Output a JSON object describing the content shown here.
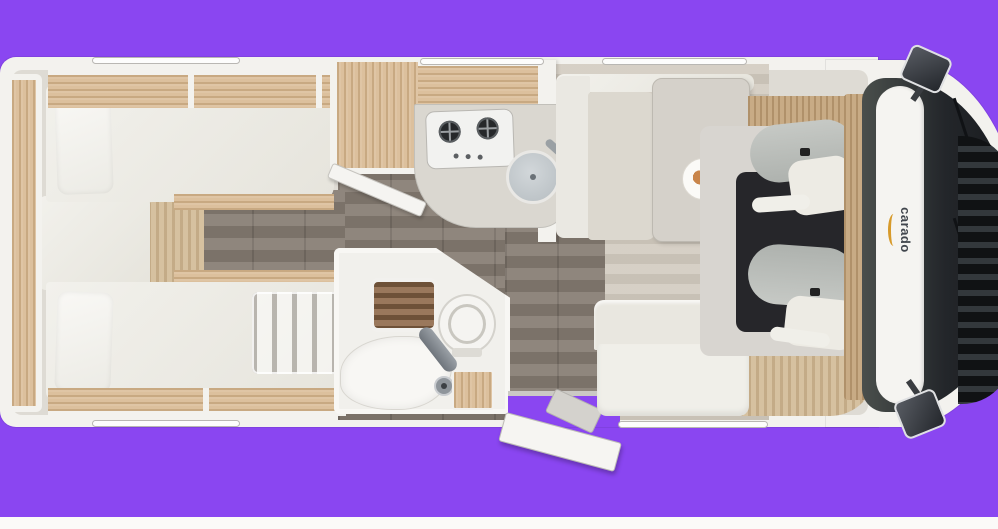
{
  "page": {
    "background_color": "#8a46f1",
    "bottom_strip_color": "#fbfaf8"
  },
  "vehicle": {
    "brand": {
      "logo_text": "carado",
      "logo_accent_color": "#d79a2b"
    },
    "palette": {
      "body_wall": "#f3f2ee",
      "furniture_wood": "#dcc09d",
      "floor_dark_wood": "#877d73",
      "floor_light": "#d1cabe",
      "upholstery": "#edece6",
      "worktop": "#dad7d0",
      "cab_mat": "#26262a"
    },
    "rooms": {
      "rear_bedroom": {
        "name": "twin-single-beds",
        "features": [
          "bed-top",
          "bed-bottom",
          "pillow-top",
          "pillow-bottom",
          "bunk-ladder",
          "overhead-lockers",
          "rear-shelf"
        ]
      },
      "kitchen": {
        "name": "kitchenette",
        "features": [
          "two-burner-hob",
          "round-sink",
          "worktop",
          "overhead-locker",
          "wardrobe"
        ]
      },
      "washroom": {
        "name": "washroom",
        "features": [
          "shower-grate",
          "toilet",
          "washbasin",
          "mixer-tap",
          "vanity-cabinet",
          "washroom-door-open"
        ]
      },
      "dinette": {
        "name": "half-dinette",
        "features": [
          "side-bench",
          "rear-bench",
          "table",
          "plate-of-food"
        ]
      },
      "cab": {
        "name": "driver-cab",
        "features": [
          "swivel-seat-driver",
          "swivel-seat-passenger",
          "dashboard",
          "windscreen",
          "front-grille",
          "mirror-left",
          "mirror-right"
        ]
      },
      "entrance": {
        "name": "entrance",
        "features": [
          "entry-door-open",
          "entry-step",
          "door-threshold"
        ]
      }
    }
  }
}
